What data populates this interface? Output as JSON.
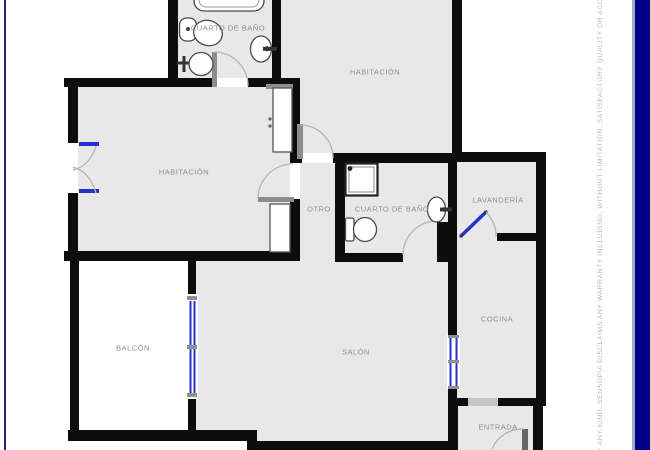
{
  "title": "Apartment floor plan",
  "rooms": {
    "bano_top": {
      "label": "CUARTO DE BAÑO",
      "x": 228,
      "y": 28
    },
    "hab_right": {
      "label": "HABITACIÓN",
      "x": 375,
      "y": 72
    },
    "hab_left": {
      "label": "HABITACIÓN",
      "x": 184,
      "y": 172
    },
    "otro": {
      "label": "OTRO",
      "x": 319,
      "y": 209
    },
    "bano_mid": {
      "label": "CUARTO DE BAÑO",
      "x": 392,
      "y": 209
    },
    "lavanderia": {
      "label": "LAVANDERÍA",
      "x": 498,
      "y": 200
    },
    "cocina": {
      "label": "COCINA",
      "x": 497,
      "y": 319
    },
    "balcon": {
      "label": "BALCÓN",
      "x": 133,
      "y": 348
    },
    "salon": {
      "label": "SALÓN",
      "x": 356,
      "y": 352
    },
    "entrada": {
      "label": "ENTRADA",
      "x": 498,
      "y": 427
    }
  },
  "watermark": {
    "text": "F ANY KIND. SENSOPIA DISCLAIMS ANY WARRANTY INCLUDING, WITHOUT LIMITATION, SATISFACTORY QUALITY OR ACCURACY OF DIMENS"
  },
  "colors": {
    "wall": "#0d0d0d",
    "room_fill": "#e8e8e9",
    "threshold": "#c6c6c6",
    "window_blue": "#2433c8",
    "arc_gray": "#b5b5b5",
    "leaf_gray": "#8c8c8c",
    "fixture_stroke": "#4a4a4a",
    "label_gray": "#8f8f8f",
    "border_navy": "#00008b",
    "border_edge": "#a9a9c4",
    "border_left_line": "#232378",
    "watermark_gray": "#b9b9bd"
  }
}
